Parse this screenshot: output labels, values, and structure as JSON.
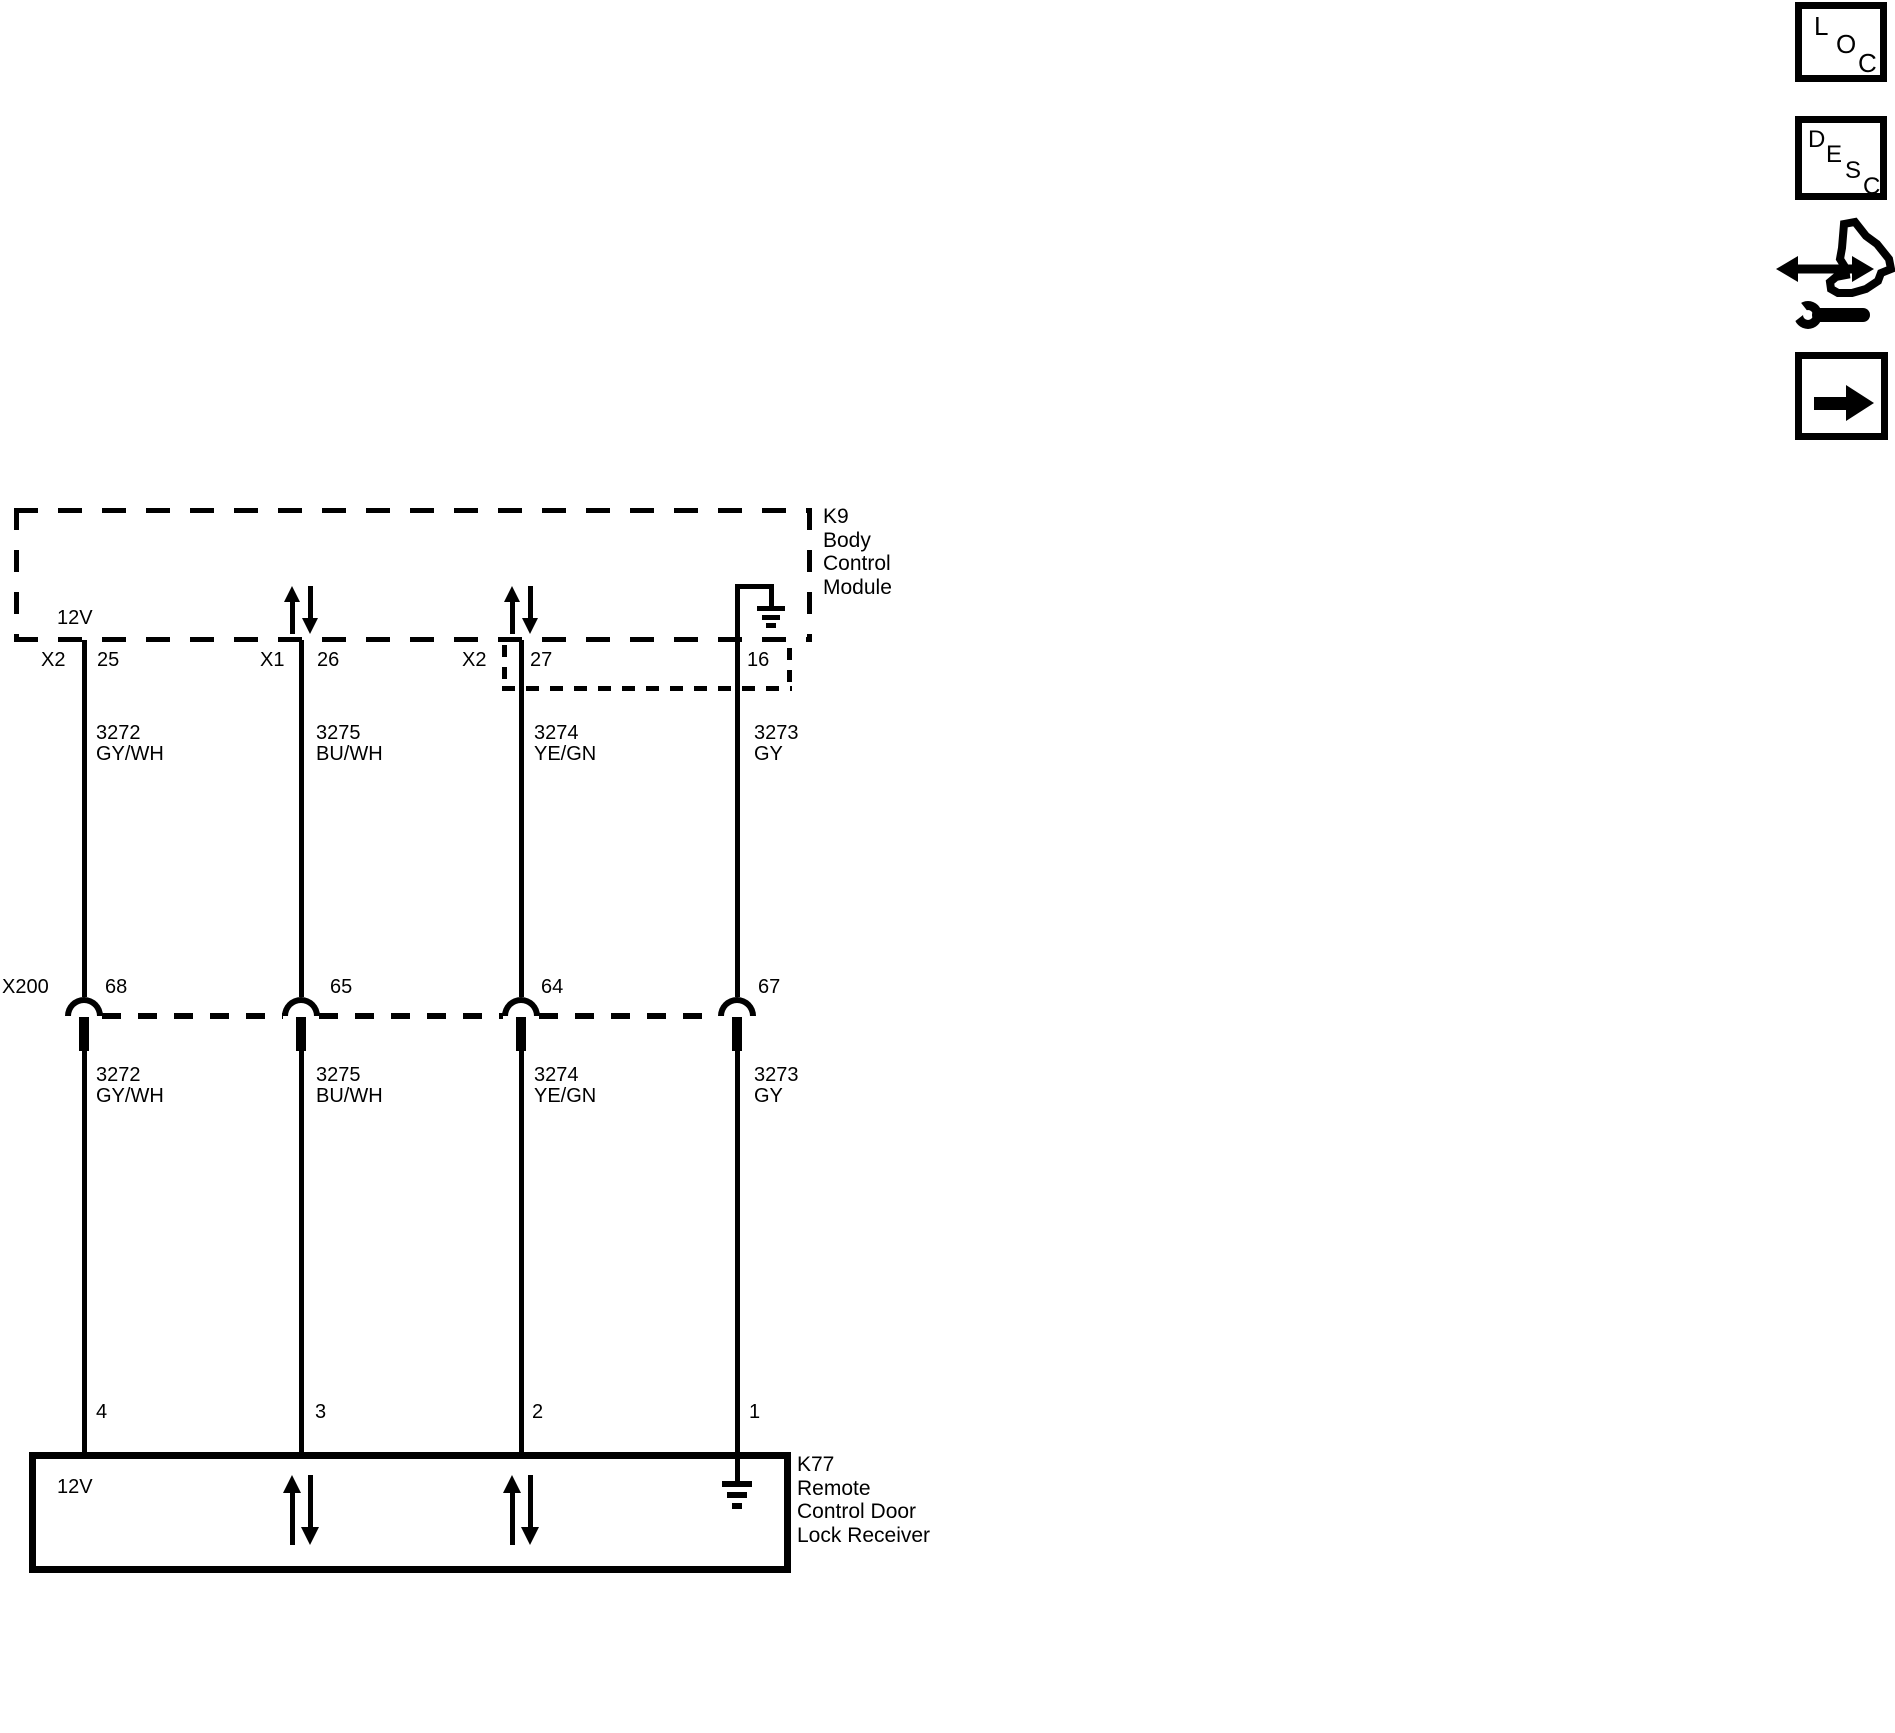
{
  "nav": {
    "loc_letters": [
      "L",
      "O",
      "C"
    ],
    "desc_letters": [
      "D",
      "E",
      "S",
      "C"
    ]
  },
  "bcm": {
    "name_lines": [
      "K9",
      "Body",
      "Control",
      "Module"
    ],
    "supply_label": "12V",
    "pins": [
      {
        "connector": "X2",
        "pin": "25"
      },
      {
        "connector": "X1",
        "pin": "26"
      },
      {
        "connector": "X2",
        "pin": "27"
      },
      {
        "connector": "",
        "pin": "16"
      }
    ]
  },
  "inline_connector": {
    "label": "X200",
    "pins": [
      "68",
      "65",
      "64",
      "67"
    ]
  },
  "wires": [
    {
      "circuit": "3272",
      "color": "GY/WH"
    },
    {
      "circuit": "3275",
      "color": "BU/WH"
    },
    {
      "circuit": "3274",
      "color": "YE/GN"
    },
    {
      "circuit": "3273",
      "color": "GY"
    }
  ],
  "receiver": {
    "name_lines": [
      "K77",
      "Remote",
      "Control Door",
      "Lock Receiver"
    ],
    "supply_label": "12V",
    "pins": [
      "4",
      "3",
      "2",
      "1"
    ]
  },
  "palette": {
    "ink": "#000000",
    "paper": "#ffffff"
  }
}
